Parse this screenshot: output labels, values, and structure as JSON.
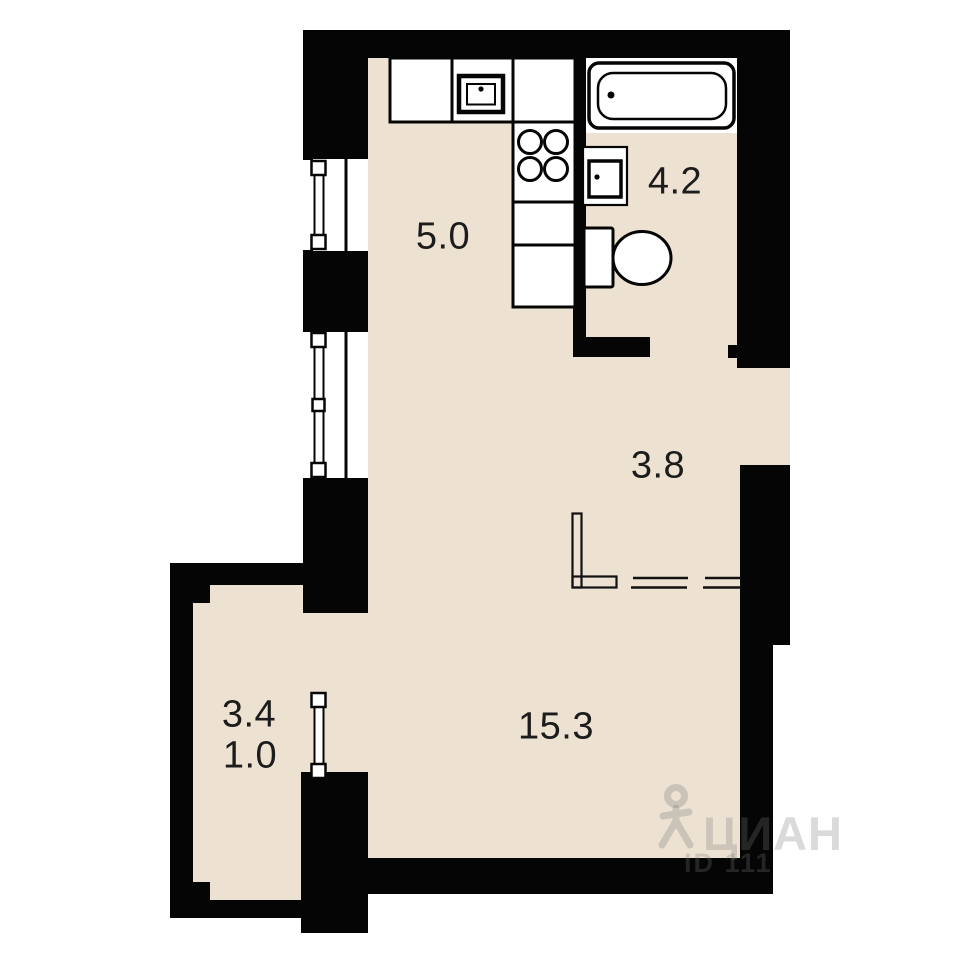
{
  "plan": {
    "title": "studio apartment floor plan",
    "rooms": [
      {
        "key": "kitchen",
        "area": "5.0"
      },
      {
        "key": "bathroom",
        "area": "4.2"
      },
      {
        "key": "hallway",
        "area": "3.8"
      },
      {
        "key": "living-room",
        "area": "15.3"
      },
      {
        "key": "balcony",
        "area": "3.4"
      },
      {
        "key": "balcony-reduced",
        "area": "1.0"
      }
    ],
    "watermark": {
      "brand": "ЦИАН",
      "listing_id": "ID 111"
    },
    "colors": {
      "floor": "#ede2d1",
      "wall": "#050505",
      "fixture": "#ffffff",
      "line": "#111111",
      "label": "#1c1c1c"
    }
  }
}
